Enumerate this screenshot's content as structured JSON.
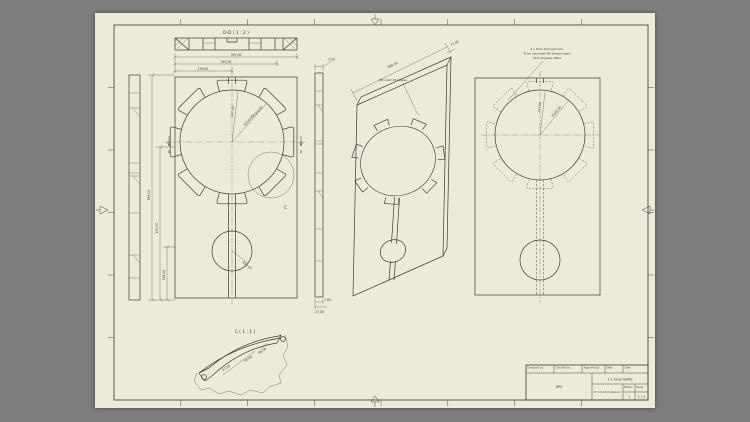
{
  "colors": {
    "surround": "#7d7d7d",
    "sheet": "#edead9",
    "line": "#3c3c34",
    "dim": "#55554a"
  },
  "labels": {
    "section": "D-D ( 1 : 2 )",
    "detail": "C ( 1 : 1 )",
    "section_ref": "D",
    "detail_ref": "C"
  },
  "notes": {
    "iso_note": "M8 nuts/ 45 degree",
    "right_note_1": "4 x 4mm through hole.",
    "right_note_2": "To be used with M5 thread insert",
    "right_note_3": "22,5 degrees offset"
  },
  "dims": {
    "total_width": "395,00",
    "width_2": "325,00",
    "width_3": "178,00",
    "height_total": "698,00",
    "height_2": "470,00",
    "height_3": "166,00",
    "radial_1": "147,50",
    "radial_2": "R150,00",
    "radial_3": "R160,00",
    "pendulum_r": "R50,00",
    "strip_top": "7,50",
    "strip_b1": "7,64",
    "strip_b2": "27,00",
    "iso_len": "698,00",
    "iso_thk": "27,00",
    "detail_1": "67,50",
    "detail_2": "R5,00",
    "detail_3": "45,00",
    "right_radial_1": "147,50",
    "right_radial_2": "R160,00"
  },
  "title_block": {
    "h_designed": "Designed by",
    "h_checked": "Checked by",
    "h_approved": "Approved by",
    "h_date": "Date",
    "h_date2": "Date",
    "project": "HP5",
    "title": "2 x Inner baffle",
    "material": "27 mm birch plywood",
    "h_edition": "Edition",
    "h_sheet": "Sheet",
    "edition": "1",
    "sheet": "1 / 1"
  }
}
